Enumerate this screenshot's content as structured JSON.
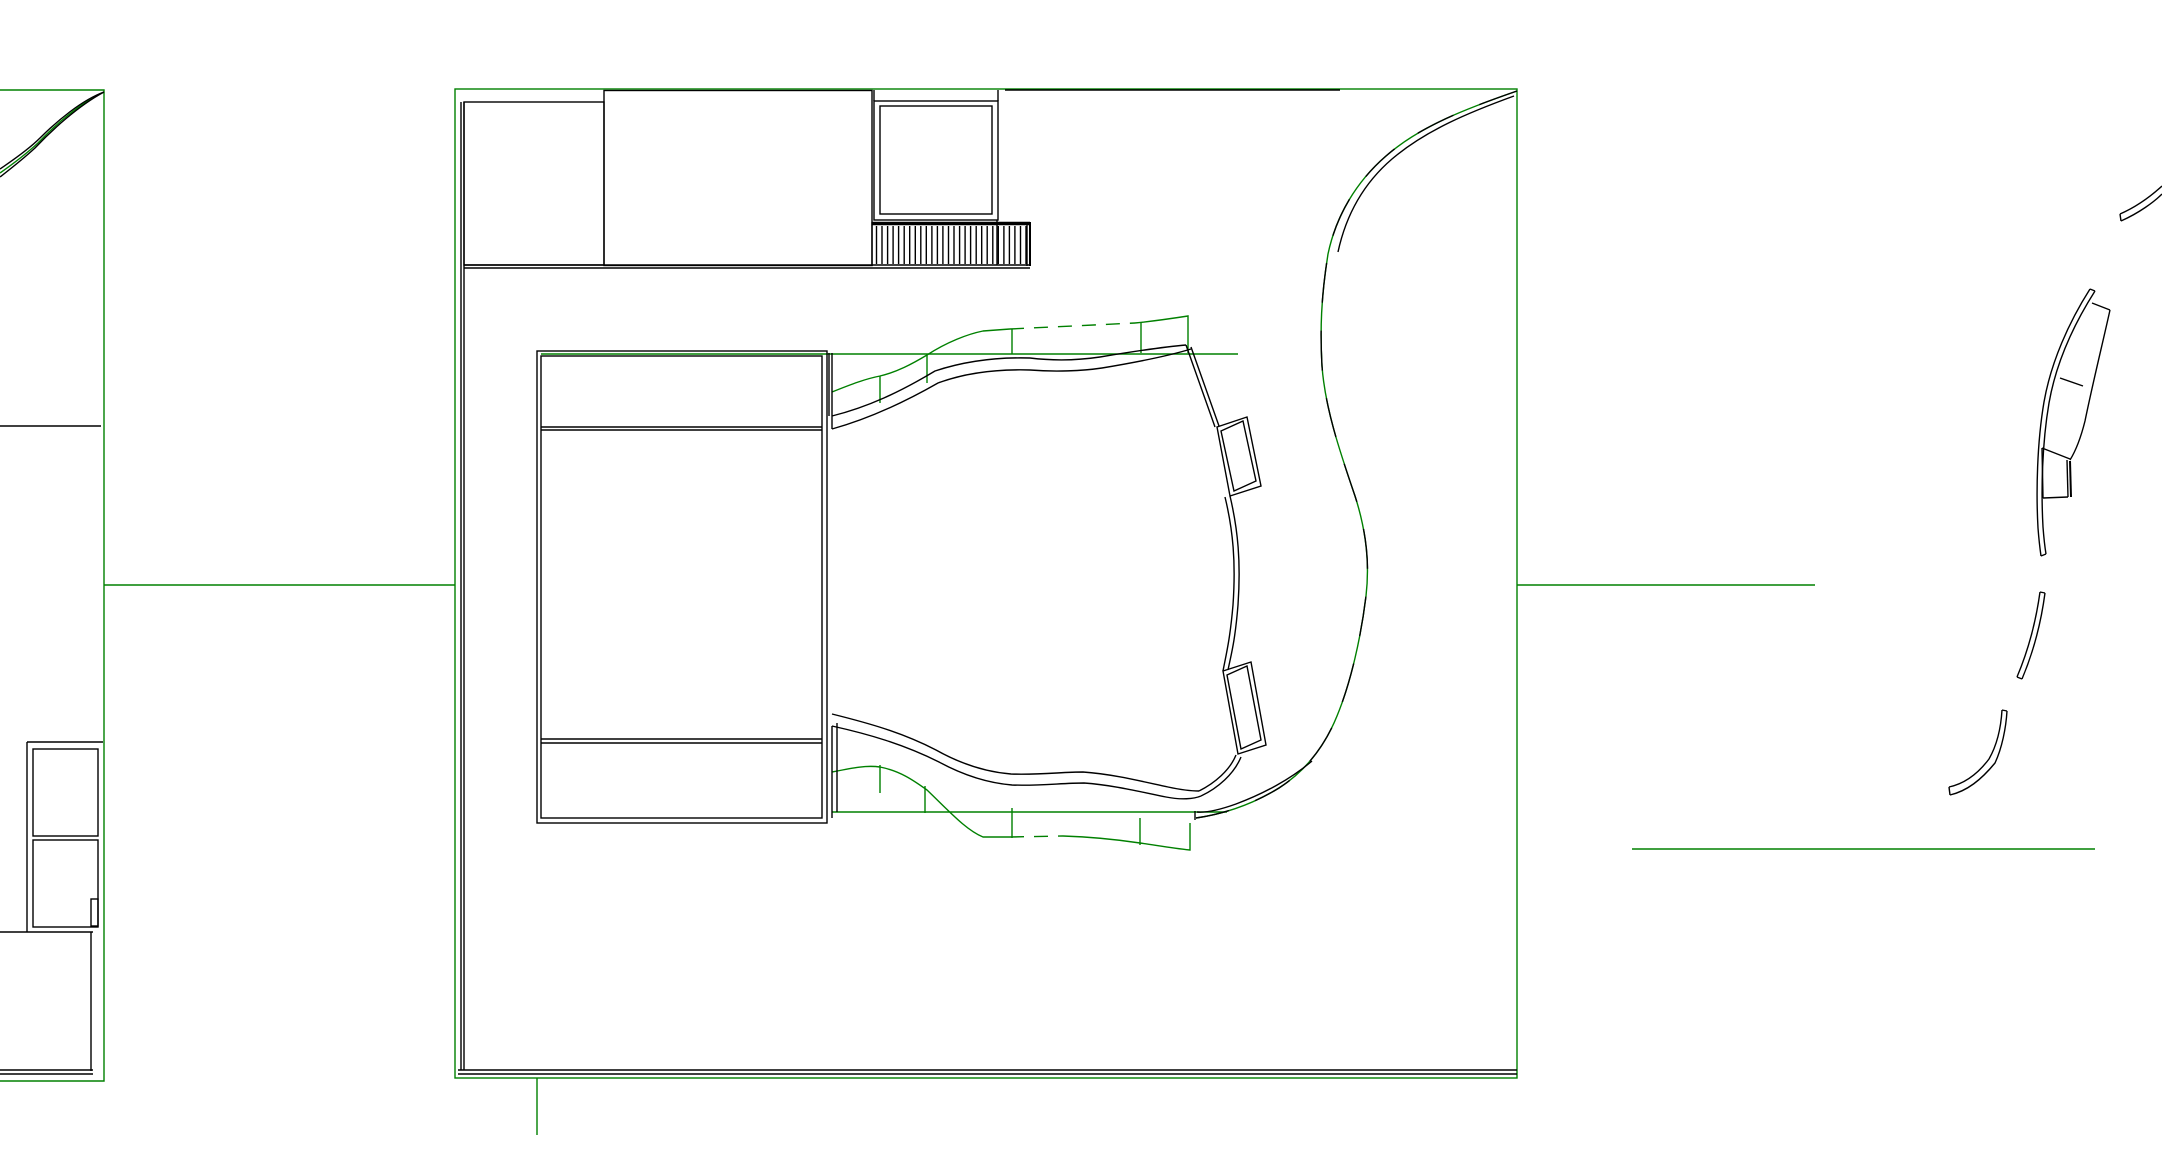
{
  "canvas": {
    "width": 2162,
    "height": 1152,
    "background": "#ffffff"
  },
  "colors": {
    "line": "#000000",
    "landscape": "#008000"
  },
  "shapes": [
    {
      "name": "left-site-boundary",
      "kind": "path",
      "color": "landscape",
      "d": "M0,90 H104 V1081 H0"
    },
    {
      "name": "left-entry-curve-green",
      "kind": "path",
      "color": "landscape",
      "d": "M104,92 C80,103 55,125 38,143 C25,155 10,166 0,173"
    },
    {
      "name": "green-connector-left",
      "kind": "line",
      "color": "landscape",
      "x1": 104,
      "y1": 585,
      "x2": 455,
      "y2": 585
    },
    {
      "name": "main-site-boundary",
      "kind": "rect",
      "color": "landscape",
      "x": 455,
      "y": 89,
      "w2": 1062,
      "h2": 989
    },
    {
      "name": "green-connector-right",
      "kind": "line",
      "color": "landscape",
      "x1": 1517,
      "y1": 585,
      "x2": 1815,
      "y2": 585
    },
    {
      "name": "green-line-lower-right",
      "kind": "line",
      "color": "landscape",
      "x1": 1632,
      "y1": 849,
      "x2": 2095,
      "y2": 849
    },
    {
      "name": "green-stub-bottom",
      "kind": "line",
      "color": "landscape",
      "x1": 537,
      "y1": 1078,
      "x2": 537,
      "y2": 1135
    },
    {
      "name": "contour-top-straight",
      "kind": "line",
      "color": "landscape",
      "x1": 541,
      "y1": 354,
      "x2": 1238,
      "y2": 354
    },
    {
      "name": "contour-top-wavy",
      "kind": "path",
      "color": "landscape",
      "d": "M832,392 C852,384 865,379 880,376 C897,372 912,364 927,355 C947,342 968,334 983,331 L1010,329"
    },
    {
      "name": "contour-top-wavy-dashed",
      "kind": "path",
      "color": "landscape",
      "dash": "14 10",
      "d": "M1010,329 L1135,323"
    },
    {
      "name": "contour-top-wavy-end",
      "kind": "path",
      "color": "landscape",
      "d": "M1135,323 C1155,321 1175,318 1188,316 L1188,353"
    },
    {
      "name": "contour-tick-top-1",
      "kind": "line",
      "color": "landscape",
      "x1": 880,
      "y1": 376,
      "x2": 880,
      "y2": 403
    },
    {
      "name": "contour-tick-top-2",
      "kind": "line",
      "color": "landscape",
      "x1": 927,
      "y1": 355,
      "x2": 927,
      "y2": 383
    },
    {
      "name": "contour-tick-top-3",
      "kind": "line",
      "color": "landscape",
      "x1": 1012,
      "y1": 329,
      "x2": 1012,
      "y2": 354
    },
    {
      "name": "contour-tick-top-4",
      "kind": "line",
      "color": "landscape",
      "x1": 1141,
      "y1": 322,
      "x2": 1141,
      "y2": 353
    },
    {
      "name": "contour-bottom-straight",
      "kind": "line",
      "color": "landscape",
      "x1": 832,
      "y1": 812,
      "x2": 1227,
      "y2": 812
    },
    {
      "name": "contour-bottom-wavy",
      "kind": "path",
      "color": "landscape",
      "d": "M832,772 C852,768 866,765 880,767 C900,771 913,780 927,790 C950,812 966,830 983,837 L1010,837"
    },
    {
      "name": "contour-bottom-wavy-dashed",
      "kind": "path",
      "color": "landscape",
      "dash": "14 10",
      "d": "M1010,837 L1063,836"
    },
    {
      "name": "contour-bottom-wavy-end",
      "kind": "path",
      "color": "landscape",
      "d": "M1063,836 C1095,837 1120,840 1140,843 C1155,845 1170,848 1190,850 L1190,823"
    },
    {
      "name": "contour-tick-bottom-1",
      "kind": "line",
      "color": "landscape",
      "x1": 880,
      "y1": 765,
      "x2": 880,
      "y2": 793
    },
    {
      "name": "contour-tick-bottom-2",
      "kind": "line",
      "color": "landscape",
      "x1": 925,
      "y1": 786,
      "x2": 925,
      "y2": 813
    },
    {
      "name": "contour-tick-bottom-3",
      "kind": "line",
      "color": "landscape",
      "x1": 1012,
      "y1": 808,
      "x2": 1012,
      "y2": 838
    },
    {
      "name": "contour-tick-bottom-4",
      "kind": "line",
      "color": "landscape",
      "x1": 1140,
      "y1": 818,
      "x2": 1140,
      "y2": 845
    },
    {
      "name": "s-path-green",
      "kind": "path",
      "color": "landscape",
      "d": "M1517,91 C1468,108 1420,126 1386,156 C1356,182 1336,216 1328,254 C1321,298 1320,330 1322,366 C1325,408 1340,452 1355,496 C1366,530 1370,562 1366,596 C1361,637 1351,682 1337,716 C1324,748 1304,772 1279,788 C1253,804 1224,814 1196,818"
    },
    {
      "name": "left-entry-curve-outer",
      "kind": "path",
      "color": "line",
      "d": "M104,92 C78,106 52,130 35,148 C22,160 9,170 0,177"
    },
    {
      "name": "left-entry-curve-inner",
      "kind": "path",
      "color": "line",
      "d": "M104,92 C82,100 57,121 40,138 C27,151 10,162 0,169"
    },
    {
      "name": "left-road-line",
      "kind": "line",
      "color": "line",
      "x1": 0,
      "y1": 426,
      "x2": 101,
      "y2": 426
    },
    {
      "name": "left-rooms-top",
      "kind": "line",
      "color": "line",
      "x1": 27,
      "y1": 742,
      "x2": 103,
      "y2": 742
    },
    {
      "name": "left-rooms-left",
      "kind": "line",
      "color": "line",
      "x1": 27,
      "y1": 742,
      "x2": 27,
      "y2": 932
    },
    {
      "name": "left-room-1",
      "kind": "rect",
      "color": "line",
      "x": 33,
      "y": 749,
      "w2": 65,
      "h2": 87
    },
    {
      "name": "left-room-2",
      "kind": "rect",
      "color": "line",
      "x": 33,
      "y": 840,
      "w2": 65,
      "h2": 87
    },
    {
      "name": "left-room-notch",
      "kind": "rect",
      "color": "line",
      "x": 91,
      "y": 899,
      "w2": 7,
      "h2": 27
    },
    {
      "name": "left-rooms-divider",
      "kind": "line",
      "color": "line",
      "x1": 0,
      "y1": 932,
      "x2": 93,
      "y2": 932
    },
    {
      "name": "left-wall-vertical",
      "kind": "line",
      "color": "line",
      "x1": 91,
      "y1": 932,
      "x2": 91,
      "y2": 1071
    },
    {
      "name": "left-bottom-wall-1",
      "kind": "line",
      "color": "line",
      "x1": 0,
      "y1": 1070,
      "x2": 93,
      "y2": 1070
    },
    {
      "name": "left-bottom-wall-2",
      "kind": "line",
      "color": "line",
      "x1": 0,
      "y1": 1074,
      "x2": 93,
      "y2": 1074
    },
    {
      "name": "site-top-dark-overlay",
      "kind": "line",
      "color": "line",
      "x1": 1005,
      "y1": 90,
      "x2": 1340,
      "y2": 90
    },
    {
      "name": "site-wall-left-1",
      "kind": "line",
      "color": "line",
      "x1": 461,
      "y1": 102,
      "x2": 461,
      "y2": 1070
    },
    {
      "name": "site-wall-left-2",
      "kind": "line",
      "color": "line",
      "x1": 464,
      "y1": 102,
      "x2": 464,
      "y2": 1070
    },
    {
      "name": "site-wall-bottom-1",
      "kind": "line",
      "color": "line",
      "x1": 458,
      "y1": 1070,
      "x2": 1517,
      "y2": 1070
    },
    {
      "name": "site-wall-bottom-2",
      "kind": "line",
      "color": "line",
      "x1": 458,
      "y1": 1074,
      "x2": 1517,
      "y2": 1074
    },
    {
      "name": "block-a",
      "kind": "rect",
      "color": "line",
      "x": 464,
      "y": 102,
      "w2": 140,
      "h2": 163
    },
    {
      "name": "block-b",
      "kind": "rect",
      "color": "line",
      "x": 604,
      "y": 90.5,
      "w2": 268,
      "h2": 175
    },
    {
      "name": "upper-band-line-1",
      "kind": "line",
      "color": "line",
      "x1": 464,
      "y1": 265,
      "x2": 1030,
      "y2": 265
    },
    {
      "name": "upper-band-line-2",
      "kind": "line",
      "color": "line",
      "x1": 464,
      "y1": 268,
      "x2": 1030,
      "y2": 268
    },
    {
      "name": "pavilion-outer",
      "kind": "rect",
      "color": "line",
      "x": 874,
      "y": 101,
      "w2": 124,
      "h2": 119
    },
    {
      "name": "pavilion-inner",
      "kind": "rect",
      "color": "line",
      "x": 880,
      "y": 106,
      "w2": 112,
      "h2": 108
    },
    {
      "name": "pavilion-stub-left",
      "kind": "line",
      "color": "line",
      "x1": 874,
      "y1": 90,
      "x2": 874,
      "y2": 101
    },
    {
      "name": "pavilion-stub-right",
      "kind": "line",
      "color": "line",
      "x1": 998,
      "y1": 90,
      "x2": 998,
      "y2": 101
    },
    {
      "name": "pavilion-right-extension",
      "kind": "line",
      "color": "line",
      "x1": 997,
      "y1": 220,
      "x2": 997,
      "y2": 265
    },
    {
      "name": "stairs-top-edge",
      "kind": "line",
      "color": "line",
      "w": 3.5,
      "x1": 872,
      "y1": 223.5,
      "x2": 1030,
      "y2": 223.5
    },
    {
      "name": "stairs-left-edge",
      "kind": "line",
      "color": "line",
      "x1": 872,
      "y1": 222,
      "x2": 872,
      "y2": 266
    },
    {
      "name": "stairs-right-edge-1",
      "kind": "line",
      "color": "line",
      "x1": 1027,
      "y1": 222,
      "x2": 1027,
      "y2": 266
    },
    {
      "name": "stairs-right-edge-2",
      "kind": "line",
      "color": "line",
      "w": 2,
      "x1": 1030,
      "y1": 222,
      "x2": 1030,
      "y2": 266
    },
    {
      "name": "stairs-treads",
      "kind": "vlines",
      "color": "line",
      "x1": 876.5,
      "x2": 1026,
      "count": 28,
      "y1": 226,
      "y2": 264
    },
    {
      "name": "building-outer",
      "kind": "rect",
      "color": "line",
      "x": 537,
      "y": 351,
      "w2": 290,
      "h2": 472
    },
    {
      "name": "building-inner",
      "kind": "rect",
      "color": "line",
      "x": 541,
      "y": 356,
      "w2": 281,
      "h2": 462
    },
    {
      "name": "building-band-top-1",
      "kind": "line",
      "color": "line",
      "x1": 541,
      "y1": 427,
      "x2": 822,
      "y2": 427
    },
    {
      "name": "building-band-top-2",
      "kind": "line",
      "color": "line",
      "x1": 541,
      "y1": 430,
      "x2": 822,
      "y2": 430
    },
    {
      "name": "building-band-bottom-1",
      "kind": "line",
      "color": "line",
      "x1": 541,
      "y1": 739,
      "x2": 822,
      "y2": 739
    },
    {
      "name": "building-band-bottom-2",
      "kind": "line",
      "color": "line",
      "x1": 541,
      "y1": 743,
      "x2": 822,
      "y2": 743
    },
    {
      "name": "building-stub-top-1",
      "kind": "line",
      "color": "line",
      "x1": 829,
      "y1": 353,
      "x2": 829,
      "y2": 416
    },
    {
      "name": "building-stub-top-2",
      "kind": "line",
      "color": "line",
      "x1": 832,
      "y1": 353,
      "x2": 832,
      "y2": 429
    },
    {
      "name": "building-stub-bottom-1",
      "kind": "line",
      "color": "line",
      "x1": 832,
      "y1": 726,
      "x2": 832,
      "y2": 818
    },
    {
      "name": "building-stub-bottom-2",
      "kind": "line",
      "color": "line",
      "x1": 837,
      "y1": 723,
      "x2": 837,
      "y2": 812
    },
    {
      "name": "terrace-top-edge-outer",
      "kind": "path",
      "color": "line",
      "d": "M832,416 C868,407 900,392 935,371 C962,362 995,357 1030,358 C1055,361 1080,360 1100,357 C1130,352 1162,347 1186,345"
    },
    {
      "name": "terrace-top-edge-inner",
      "kind": "path",
      "color": "line",
      "d": "M832,429 C868,419 903,403 938,383 C965,373 996,369 1030,370 C1055,372 1082,371 1102,368 C1132,363 1165,357 1191,349"
    },
    {
      "name": "terrace-wall-upper-1",
      "kind": "line",
      "color": "line",
      "x1": 1186,
      "y1": 345,
      "x2": 1215,
      "y2": 427
    },
    {
      "name": "terrace-wall-upper-2",
      "kind": "line",
      "color": "line",
      "x1": 1191,
      "y1": 347,
      "x2": 1219,
      "y2": 426
    },
    {
      "name": "balcony-box-1-outer",
      "kind": "polygon",
      "color": "line",
      "points": "1217,427 1247,417 1261,486 1230,496"
    },
    {
      "name": "balcony-box-1-inner",
      "kind": "polygon",
      "color": "line",
      "points": "1221,431 1243,421 1256,481 1234,491"
    },
    {
      "name": "terrace-wall-mid-1",
      "kind": "path",
      "color": "line",
      "d": "M1225,497 C1233,530 1236,562 1233,605 C1230,640 1226,655 1223,671"
    },
    {
      "name": "terrace-wall-mid-2",
      "kind": "path",
      "color": "line",
      "d": "M1230,496 C1238,530 1241,562 1238,605 C1235,642 1231,655 1228,670"
    },
    {
      "name": "balcony-box-2-outer",
      "kind": "polygon",
      "color": "line",
      "points": "1223,671 1251,662 1266,745 1238,754"
    },
    {
      "name": "balcony-box-2-inner",
      "kind": "polygon",
      "color": "line",
      "points": "1227,675 1247,666 1261,740 1241,749"
    },
    {
      "name": "terrace-wall-lower-1",
      "kind": "path",
      "color": "line",
      "d": "M1236,755 C1230,770 1215,783 1199,791"
    },
    {
      "name": "terrace-wall-lower-2",
      "kind": "path",
      "color": "line",
      "d": "M1241,757 C1234,774 1218,788 1201,796"
    },
    {
      "name": "terrace-bottom-edge-outer",
      "kind": "path",
      "color": "line",
      "d": "M832,714 C868,723 901,732 936,750 C961,764 986,772 1011,774 C1040,775 1062,772 1083,772 C1112,774 1140,781 1168,787 C1182,790 1193,791 1199,791"
    },
    {
      "name": "terrace-bottom-edge-inner",
      "kind": "path",
      "color": "line",
      "d": "M832,726 C868,734 903,744 939,762 C963,775 988,783 1012,785 C1040,786 1062,783 1084,783 C1113,785 1141,792 1166,797 C1181,800 1194,799 1201,796"
    },
    {
      "name": "s-path-black-dashes",
      "kind": "path",
      "color": "line",
      "dash": "40 28",
      "d": "M1517,91 C1468,108 1420,126 1386,156 C1356,182 1336,216 1328,254 C1321,298 1320,330 1322,366 C1325,408 1340,452 1355,496 C1366,530 1370,562 1366,596 C1361,637 1351,682 1337,716 C1324,748 1304,772 1279,788 C1253,804 1224,814 1196,818"
    },
    {
      "name": "s-path-double-upper",
      "kind": "path",
      "color": "line",
      "d": "M1514,96 C1470,112 1426,130 1392,159 C1364,183 1346,215 1338,252"
    },
    {
      "name": "s-path-tail-parallel",
      "kind": "path",
      "color": "line",
      "d": "M1312,761 C1291,779 1263,794 1236,804 C1222,809 1208,813 1197,812"
    },
    {
      "name": "s-path-tail-cap",
      "kind": "line",
      "color": "line",
      "x1": 1195,
      "y1": 811,
      "x2": 1195,
      "y2": 820
    },
    {
      "name": "arc-top-outer",
      "kind": "path",
      "color": "line",
      "d": "M2120,214 C2136,207 2150,197 2162,186"
    },
    {
      "name": "arc-top-inner",
      "kind": "path",
      "color": "line",
      "d": "M2121,221 C2139,213 2154,202 2162,194"
    },
    {
      "name": "arc-top-cap",
      "kind": "line",
      "color": "line",
      "x1": 2120,
      "y1": 214,
      "x2": 2121,
      "y2": 221
    },
    {
      "name": "arc-main-outer",
      "kind": "path",
      "color": "line",
      "d": "M2090,289 C2069,322 2051,362 2044,402 C2037,443 2036,492 2038,528 C2039,541 2040,549 2041,556"
    },
    {
      "name": "arc-main-inner",
      "kind": "path",
      "color": "line",
      "d": "M2095,291 C2074,324 2056,363 2049,403 C2042,444 2041,491 2043,527 C2044,540 2045,548 2046,554"
    },
    {
      "name": "arc-main-cap-top",
      "kind": "line",
      "color": "line",
      "x1": 2090,
      "y1": 289,
      "x2": 2095,
      "y2": 291
    },
    {
      "name": "arc-main-cap-bottom",
      "kind": "line",
      "color": "line",
      "x1": 2041,
      "y1": 556,
      "x2": 2046,
      "y2": 554
    },
    {
      "name": "seat-band-top",
      "kind": "line",
      "color": "line",
      "x1": 2092,
      "y1": 303,
      "x2": 2110,
      "y2": 310
    },
    {
      "name": "seat-band-right",
      "kind": "path",
      "color": "line",
      "d": "M2110,310 C2102,346 2093,382 2085,421 C2080,441 2075,452 2070,460"
    },
    {
      "name": "seat-band-div-1",
      "kind": "line",
      "color": "line",
      "x1": 2060,
      "y1": 378,
      "x2": 2083,
      "y2": 386
    },
    {
      "name": "seat-band-div-2",
      "kind": "line",
      "color": "line",
      "x1": 2042,
      "y1": 448,
      "x2": 2070,
      "y2": 459
    },
    {
      "name": "seat-band-left-low",
      "kind": "line",
      "color": "line",
      "x1": 2042,
      "y1": 448,
      "x2": 2043,
      "y2": 498
    },
    {
      "name": "seat-band-bottom",
      "kind": "line",
      "color": "line",
      "x1": 2043,
      "y1": 498,
      "x2": 2068,
      "y2": 497
    },
    {
      "name": "seat-band-right-low-1",
      "kind": "line",
      "color": "line",
      "x1": 2067,
      "y1": 460,
      "x2": 2068,
      "y2": 497
    },
    {
      "name": "seat-band-right-low-2",
      "kind": "line",
      "color": "line",
      "w": 2,
      "x1": 2070,
      "y1": 461,
      "x2": 2071,
      "y2": 497
    },
    {
      "name": "arc-small-outer",
      "kind": "path",
      "color": "line",
      "d": "M2040,592 C2036,621 2028,651 2017,677"
    },
    {
      "name": "arc-small-inner",
      "kind": "path",
      "color": "line",
      "d": "M2045,593 C2041,623 2033,653 2022,679"
    },
    {
      "name": "arc-small-cap-top",
      "kind": "line",
      "color": "line",
      "x1": 2040,
      "y1": 592,
      "x2": 2045,
      "y2": 593
    },
    {
      "name": "arc-small-cap-bottom",
      "kind": "line",
      "color": "line",
      "x1": 2017,
      "y1": 677,
      "x2": 2022,
      "y2": 679
    },
    {
      "name": "arc-hook-outer",
      "kind": "path",
      "color": "line",
      "d": "M1949,787 C1963,784 1977,775 1989,759 C1997,745 2001,727 2002,710"
    },
    {
      "name": "arc-hook-inner",
      "kind": "path",
      "color": "line",
      "d": "M1950,795 C1967,791 1981,780 1995,763 C2002,748 2006,728 2007,711"
    },
    {
      "name": "arc-hook-cap-left",
      "kind": "line",
      "color": "line",
      "x1": 1949,
      "y1": 787,
      "x2": 1950,
      "y2": 795
    },
    {
      "name": "arc-hook-cap-top",
      "kind": "line",
      "color": "line",
      "x1": 2002,
      "y1": 710,
      "x2": 2007,
      "y2": 711
    }
  ]
}
